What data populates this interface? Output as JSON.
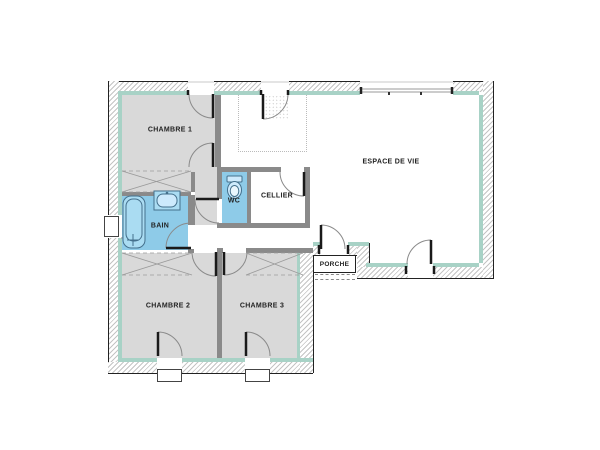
{
  "plan": {
    "type": "house-floor-plan",
    "rooms": [
      {
        "id": "chambre1",
        "label": "CHAMBRE 1",
        "fill": "#d9d9d9"
      },
      {
        "id": "chambre2",
        "label": "CHAMBRE 2",
        "fill": "#d9d9d9"
      },
      {
        "id": "chambre3",
        "label": "CHAMBRE 3",
        "fill": "#d9d9d9"
      },
      {
        "id": "bain",
        "label": "BAIN",
        "fill": "#8ecbe8"
      },
      {
        "id": "wc",
        "label": "WC",
        "fill": "#8ecbe8"
      },
      {
        "id": "cellier",
        "label": "CELLIER",
        "fill": "#ffffff"
      },
      {
        "id": "espace_de_vie",
        "label": "ESPACE DE VIE",
        "fill": "#ffffff"
      },
      {
        "id": "porche",
        "label": "PORCHE",
        "fill": "#ffffff"
      }
    ],
    "fixtures": [
      "bathtub",
      "washbasin",
      "toilet"
    ],
    "features": [
      "entry-door",
      "porch-door",
      "terrace-door",
      "bay-window",
      "casement-windows",
      "wardrobes",
      "porch-steps",
      "entrance-tiling"
    ],
    "colors": {
      "bedroom_gray": "#d9d9d9",
      "wet_room_blue": "#8ecbe8",
      "insulation_teal": "#a8d2c6",
      "interior_wall": "#8a8a8a",
      "outline": "#222222"
    }
  }
}
